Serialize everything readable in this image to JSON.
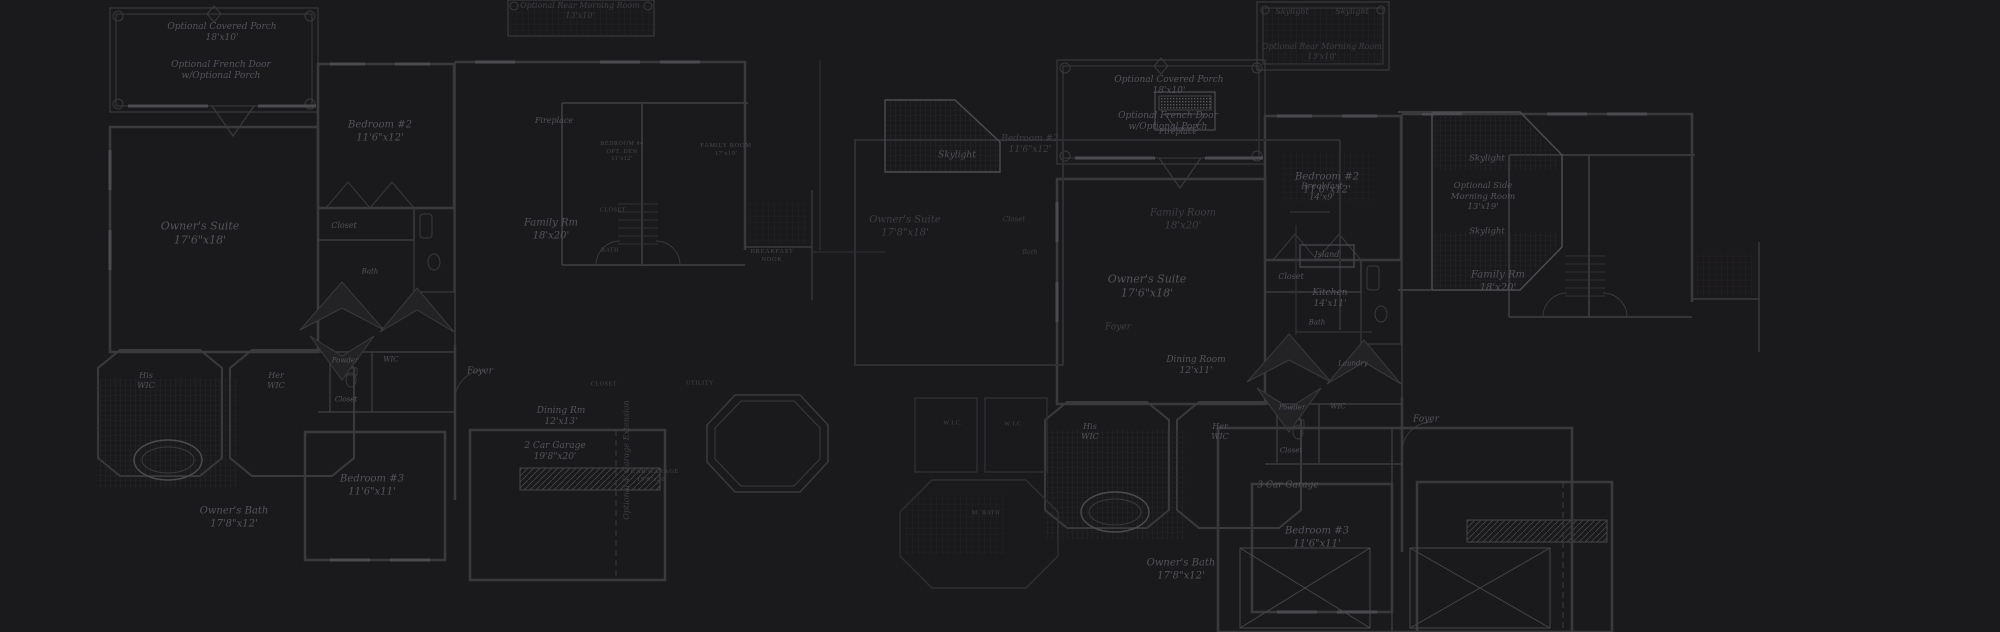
{
  "scene": {
    "background": "#1a191b",
    "wall_color": "#3a3a3d",
    "dim_wall_color": "#2e2e31",
    "bright_line_color": "#4c4c50",
    "hatch_color": "#2c2c2f",
    "label_color": "#54535b",
    "smallcaps_color": "#47464d"
  },
  "labels": [
    {
      "id": "porch-left",
      "lines": [
        "Optional Covered Porch",
        "18'x10'"
      ],
      "x": 222,
      "y": 33,
      "size": 9
    },
    {
      "id": "french-door-left",
      "lines": [
        "Optional French Door",
        "w/Optional Porch"
      ],
      "x": 221,
      "y": 71,
      "size": 9
    },
    {
      "id": "bedroom2-left",
      "lines": [
        "Bedroom #2",
        "11'6\"x12'"
      ],
      "x": 380,
      "y": 132,
      "size": 10
    },
    {
      "id": "owners-suite-left",
      "lines": [
        "Owner's Suite",
        "17'6\"x18'"
      ],
      "x": 200,
      "y": 233,
      "size": 11
    },
    {
      "id": "closet-bedroom2-left",
      "lines": [
        "Closet"
      ],
      "x": 344,
      "y": 226,
      "size": 8
    },
    {
      "id": "bath-bedroom2-left",
      "lines": [
        "Bath"
      ],
      "x": 370,
      "y": 272,
      "size": 7
    },
    {
      "id": "fireplace-left",
      "lines": [
        "Fireplace"
      ],
      "x": 554,
      "y": 121,
      "size": 8
    },
    {
      "id": "family-rm-left",
      "lines": [
        "Family Rm",
        "18'x20'"
      ],
      "x": 551,
      "y": 230,
      "size": 10
    },
    {
      "id": "bedroom4-sc",
      "lines": [
        "BEDROOM #4",
        "OPT. DEN",
        "11'x12'"
      ],
      "kind": "sc",
      "x": 622,
      "y": 152,
      "size": 6
    },
    {
      "id": "family-room-sc",
      "lines": [
        "FAMILY ROOM",
        "17'x19'"
      ],
      "kind": "sc",
      "x": 726,
      "y": 150,
      "size": 6.5
    },
    {
      "id": "closet-sc-1",
      "lines": [
        "CLOSET"
      ],
      "kind": "sc",
      "x": 613,
      "y": 211,
      "size": 6
    },
    {
      "id": "bath-sc-1",
      "lines": [
        "BATH"
      ],
      "kind": "sc",
      "x": 610,
      "y": 251,
      "size": 6
    },
    {
      "id": "breakfast-nook-sc",
      "lines": [
        "BREAKFAST",
        "NOOK"
      ],
      "kind": "sc",
      "x": 772,
      "y": 256,
      "size": 6.5
    },
    {
      "id": "foyer-left",
      "lines": [
        "Foyer"
      ],
      "x": 480,
      "y": 372,
      "size": 9
    },
    {
      "id": "powder-left",
      "lines": [
        "Powder"
      ],
      "x": 345,
      "y": 361,
      "size": 7
    },
    {
      "id": "wic-left",
      "lines": [
        "WIC"
      ],
      "x": 391,
      "y": 360,
      "size": 7
    },
    {
      "id": "closet2-left",
      "lines": [
        "Closet"
      ],
      "x": 346,
      "y": 400,
      "size": 7
    },
    {
      "id": "his-wic-left",
      "lines": [
        "His",
        "WIC"
      ],
      "x": 146,
      "y": 381,
      "size": 8
    },
    {
      "id": "her-wic-left",
      "lines": [
        "Her",
        "WIC"
      ],
      "x": 276,
      "y": 381,
      "size": 8
    },
    {
      "id": "bedroom3-left",
      "lines": [
        "Bedroom #3",
        "11'6\"x11'"
      ],
      "x": 372,
      "y": 486,
      "size": 10
    },
    {
      "id": "owners-bath-left",
      "lines": [
        "Owner's Bath",
        "17'8\"x12'"
      ],
      "x": 234,
      "y": 518,
      "size": 10
    },
    {
      "id": "dining-rm-left",
      "lines": [
        "Dining Rm",
        "12'x13'"
      ],
      "x": 561,
      "y": 417,
      "size": 9
    },
    {
      "id": "closet-sc-2",
      "lines": [
        "CLOSET"
      ],
      "kind": "sc",
      "x": 604,
      "y": 385,
      "size": 6
    },
    {
      "id": "utility-sc",
      "lines": [
        "UTILITY"
      ],
      "kind": "sc",
      "x": 700,
      "y": 384,
      "size": 6
    },
    {
      "id": "garage-left",
      "lines": [
        "2 Car Garage",
        "19'8\"x20'"
      ],
      "x": 555,
      "y": 452,
      "size": 9
    },
    {
      "id": "garage-left-sc",
      "lines": [
        "2 CAR GARAGE",
        "19'8\"x20'"
      ],
      "kind": "sc",
      "x": 652,
      "y": 476,
      "size": 6.5
    },
    {
      "id": "garage-extension",
      "lines": [
        "Optional 4' Garage Extension"
      ],
      "x": 627,
      "y": 460,
      "size": 8,
      "rot": -90,
      "dim": true
    },
    {
      "id": "morning-room-top",
      "lines": [
        "Optional Rear Morning Room",
        "13'x10'"
      ],
      "x": 580,
      "y": 11,
      "size": 8,
      "dim": true
    },
    {
      "id": "skylight-mid",
      "lines": [
        "Skylight"
      ],
      "x": 957,
      "y": 156,
      "size": 9
    },
    {
      "id": "owners-suite-right2",
      "lines": [
        "Owner's Suite",
        "17'8\"x18'"
      ],
      "x": 905,
      "y": 227,
      "size": 10,
      "dim": true
    },
    {
      "id": "bedroom2-right2",
      "lines": [
        "Bedroom #2",
        "11'6\"x12'"
      ],
      "x": 1030,
      "y": 145,
      "size": 9,
      "dim": true
    },
    {
      "id": "closet-right2",
      "lines": [
        "Closet"
      ],
      "x": 1014,
      "y": 220,
      "size": 7,
      "dim": true
    },
    {
      "id": "bath-right2",
      "lines": [
        "Bath"
      ],
      "x": 1030,
      "y": 252,
      "size": 6.5,
      "dim": true
    },
    {
      "id": "fireplace-right",
      "lines": [
        "Fireplace"
      ],
      "x": 1178,
      "y": 132,
      "size": 8
    },
    {
      "id": "family-room-right2",
      "lines": [
        "Family Room",
        "18'x20'"
      ],
      "x": 1183,
      "y": 220,
      "size": 10,
      "dim": true
    },
    {
      "id": "breakfast-right",
      "lines": [
        "Breakfast",
        "14'x9'"
      ],
      "x": 1322,
      "y": 192,
      "size": 8.5
    },
    {
      "id": "island-right",
      "lines": [
        "Island"
      ],
      "x": 1327,
      "y": 255,
      "size": 8
    },
    {
      "id": "kitchen-right",
      "lines": [
        "Kitchen",
        "14'x11'"
      ],
      "x": 1330,
      "y": 299,
      "size": 9
    },
    {
      "id": "dining-room-right",
      "lines": [
        "Dining Room",
        "12'x11'"
      ],
      "x": 1196,
      "y": 366,
      "size": 9
    },
    {
      "id": "laundry-right",
      "lines": [
        "Laundry"
      ],
      "x": 1353,
      "y": 364,
      "size": 7
    },
    {
      "id": "foyer-right2",
      "lines": [
        "Foyer"
      ],
      "x": 1118,
      "y": 328,
      "size": 9,
      "dim": true
    },
    {
      "id": "porch-right",
      "lines": [
        "Optional Covered Porch",
        "18'x10'"
      ],
      "x": 1169,
      "y": 86,
      "size": 9
    },
    {
      "id": "french-door-right",
      "lines": [
        "Optional French Door",
        "w/Optional Porch"
      ],
      "x": 1168,
      "y": 122,
      "size": 9
    },
    {
      "id": "owners-suite-right",
      "lines": [
        "Owner's Suite",
        "17'6\"x18'"
      ],
      "x": 1147,
      "y": 286,
      "size": 11
    },
    {
      "id": "bedroom2-right",
      "lines": [
        "Bedroom #2",
        "11'6\"x12'"
      ],
      "x": 1327,
      "y": 184,
      "size": 10
    },
    {
      "id": "closet-right",
      "lines": [
        "Closet"
      ],
      "x": 1291,
      "y": 277,
      "size": 8
    },
    {
      "id": "bath-right",
      "lines": [
        "Bath"
      ],
      "x": 1317,
      "y": 323,
      "size": 7
    },
    {
      "id": "family-rm-right",
      "lines": [
        "Family Rm",
        "18'x20'"
      ],
      "x": 1498,
      "y": 282,
      "size": 10
    },
    {
      "id": "powder-right",
      "lines": [
        "Powder"
      ],
      "x": 1292,
      "y": 408,
      "size": 7
    },
    {
      "id": "wic-right",
      "lines": [
        "WIC"
      ],
      "x": 1338,
      "y": 407,
      "size": 7
    },
    {
      "id": "closet2-right",
      "lines": [
        "Closet"
      ],
      "x": 1291,
      "y": 451,
      "size": 7
    },
    {
      "id": "his-wic-right",
      "lines": [
        "His",
        "WIC"
      ],
      "x": 1090,
      "y": 432,
      "size": 8
    },
    {
      "id": "her-wic-right",
      "lines": [
        "Her",
        "WIC"
      ],
      "x": 1220,
      "y": 432,
      "size": 8
    },
    {
      "id": "wic-sc-1",
      "lines": [
        "W.I.C."
      ],
      "kind": "sc",
      "x": 953,
      "y": 424,
      "size": 6
    },
    {
      "id": "wic-sc-2",
      "lines": [
        "W.I.C."
      ],
      "kind": "sc",
      "x": 1014,
      "y": 425,
      "size": 6
    },
    {
      "id": "m-bath-sc",
      "lines": [
        "M. BATH"
      ],
      "kind": "sc",
      "x": 986,
      "y": 514,
      "size": 6
    },
    {
      "id": "owners-bath-right",
      "lines": [
        "Owner's Bath",
        "17'8\"x12'"
      ],
      "x": 1181,
      "y": 570,
      "size": 10
    },
    {
      "id": "bedroom3-right",
      "lines": [
        "Bedroom #3",
        "11'6\"x11'"
      ],
      "x": 1317,
      "y": 538,
      "size": 10
    },
    {
      "id": "garage-right",
      "lines": [
        "3 Car Garage"
      ],
      "x": 1288,
      "y": 486,
      "size": 9
    },
    {
      "id": "skylight-top-1",
      "lines": [
        "Skylight"
      ],
      "x": 1292,
      "y": 12,
      "size": 8,
      "dim": true
    },
    {
      "id": "skylight-top-2",
      "lines": [
        "Skylight"
      ],
      "x": 1352,
      "y": 12,
      "size": 8,
      "dim": true
    },
    {
      "id": "morning-room-rear",
      "lines": [
        "Optional Rear Morning Room",
        "13'x10'"
      ],
      "x": 1322,
      "y": 52,
      "size": 8,
      "dim": true
    },
    {
      "id": "skylight-side-1",
      "lines": [
        "Skylight"
      ],
      "x": 1487,
      "y": 159,
      "size": 8.5
    },
    {
      "id": "morning-room-side",
      "lines": [
        "Optional Side",
        "Morning Room",
        "13'x19'"
      ],
      "x": 1483,
      "y": 197,
      "size": 8.5
    },
    {
      "id": "skylight-side-2",
      "lines": [
        "Skylight"
      ],
      "x": 1487,
      "y": 232,
      "size": 8.5
    },
    {
      "id": "foyer-right-c",
      "lines": [
        "Foyer"
      ],
      "x": 1426,
      "y": 420,
      "size": 9
    }
  ]
}
